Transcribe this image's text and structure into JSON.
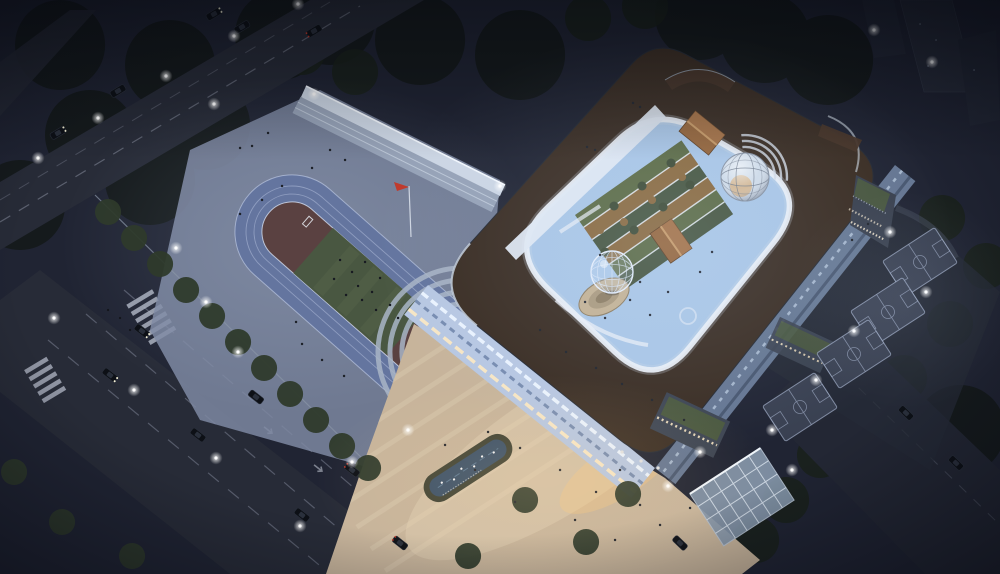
{
  "scene": {
    "type": "architectural-rendering",
    "setting": "night aerial view of a school campus",
    "features": {
      "inventory": [
        "city-roads",
        "crosswalks",
        "cars",
        "street-lights",
        "running-track",
        "soccer-field",
        "flag-pole",
        "perimeter-wall",
        "grandstand",
        "main-building-ring",
        "roof-deck",
        "oval-courtyard",
        "rooftop-garden",
        "gabled-pavilions",
        "geodesic-dome",
        "globe-sculpture",
        "sunken-amphitheater",
        "entrance-plaza",
        "reflecting-pool",
        "bird-sculptures",
        "glass-canopy",
        "basketball-courts",
        "green-roof-annexes",
        "street-trees",
        "high-rise-towers"
      ],
      "track_lane_count": 6,
      "basketball_court_count": 4,
      "rooftop_pavilion_count": 2,
      "flag_color": "red",
      "time_of_day": "night"
    },
    "palette": {
      "night": "#202433",
      "road": "#272b37",
      "roadLine": "#9aa0b2",
      "crosswalk": "#b2b8c6",
      "apron": "#7e88a2",
      "wall": "#ccd6e4",
      "fence": "#8a95a6",
      "track": "#64759f",
      "trackLine": "#b9c5e2",
      "infield": "#5a4141",
      "field": "#495741",
      "fieldStripe": "#55624a",
      "roof": "#3a2d23",
      "facade": "#b7c7e2",
      "facadeSide": "#6d7f9c",
      "windowLight": "#eaf3fe",
      "windowDark": "#6d82a8",
      "windowWarm": "#ffeac2",
      "rim": "#e9eef6",
      "innerFacade": "#dfe8f2",
      "courtyard": "#a9c6e6",
      "gardenGreen": "#5c6b45",
      "gardenAmber": "#8a6a3f",
      "gardenDark": "#475640",
      "house": "#95653a",
      "houseRidge": "#c89a66",
      "domeGlass": "#cfdbe8",
      "domeGlow": "#d99a4e",
      "globe": "#e6eefb",
      "pit": "#c4b294",
      "plaza": "#c7b49b",
      "plazaStripe": "#d9c9af",
      "poolWater": "#3a5068",
      "poolRim": "#3f4234",
      "court": "#394051",
      "courtLine": "#9aa6bf",
      "canopy": "#8698ac",
      "greenRoof": "#49573e",
      "towers": "#272c3a",
      "treeDark": "#141a19",
      "treeMid": "#1a211c",
      "treeLit": "#2e3a2b",
      "car": "#0d1016",
      "flag": "#c0392b",
      "people": "#1d2128",
      "glowWarm": "#ffd9a0",
      "glowCool": "#cfe2ff"
    }
  }
}
